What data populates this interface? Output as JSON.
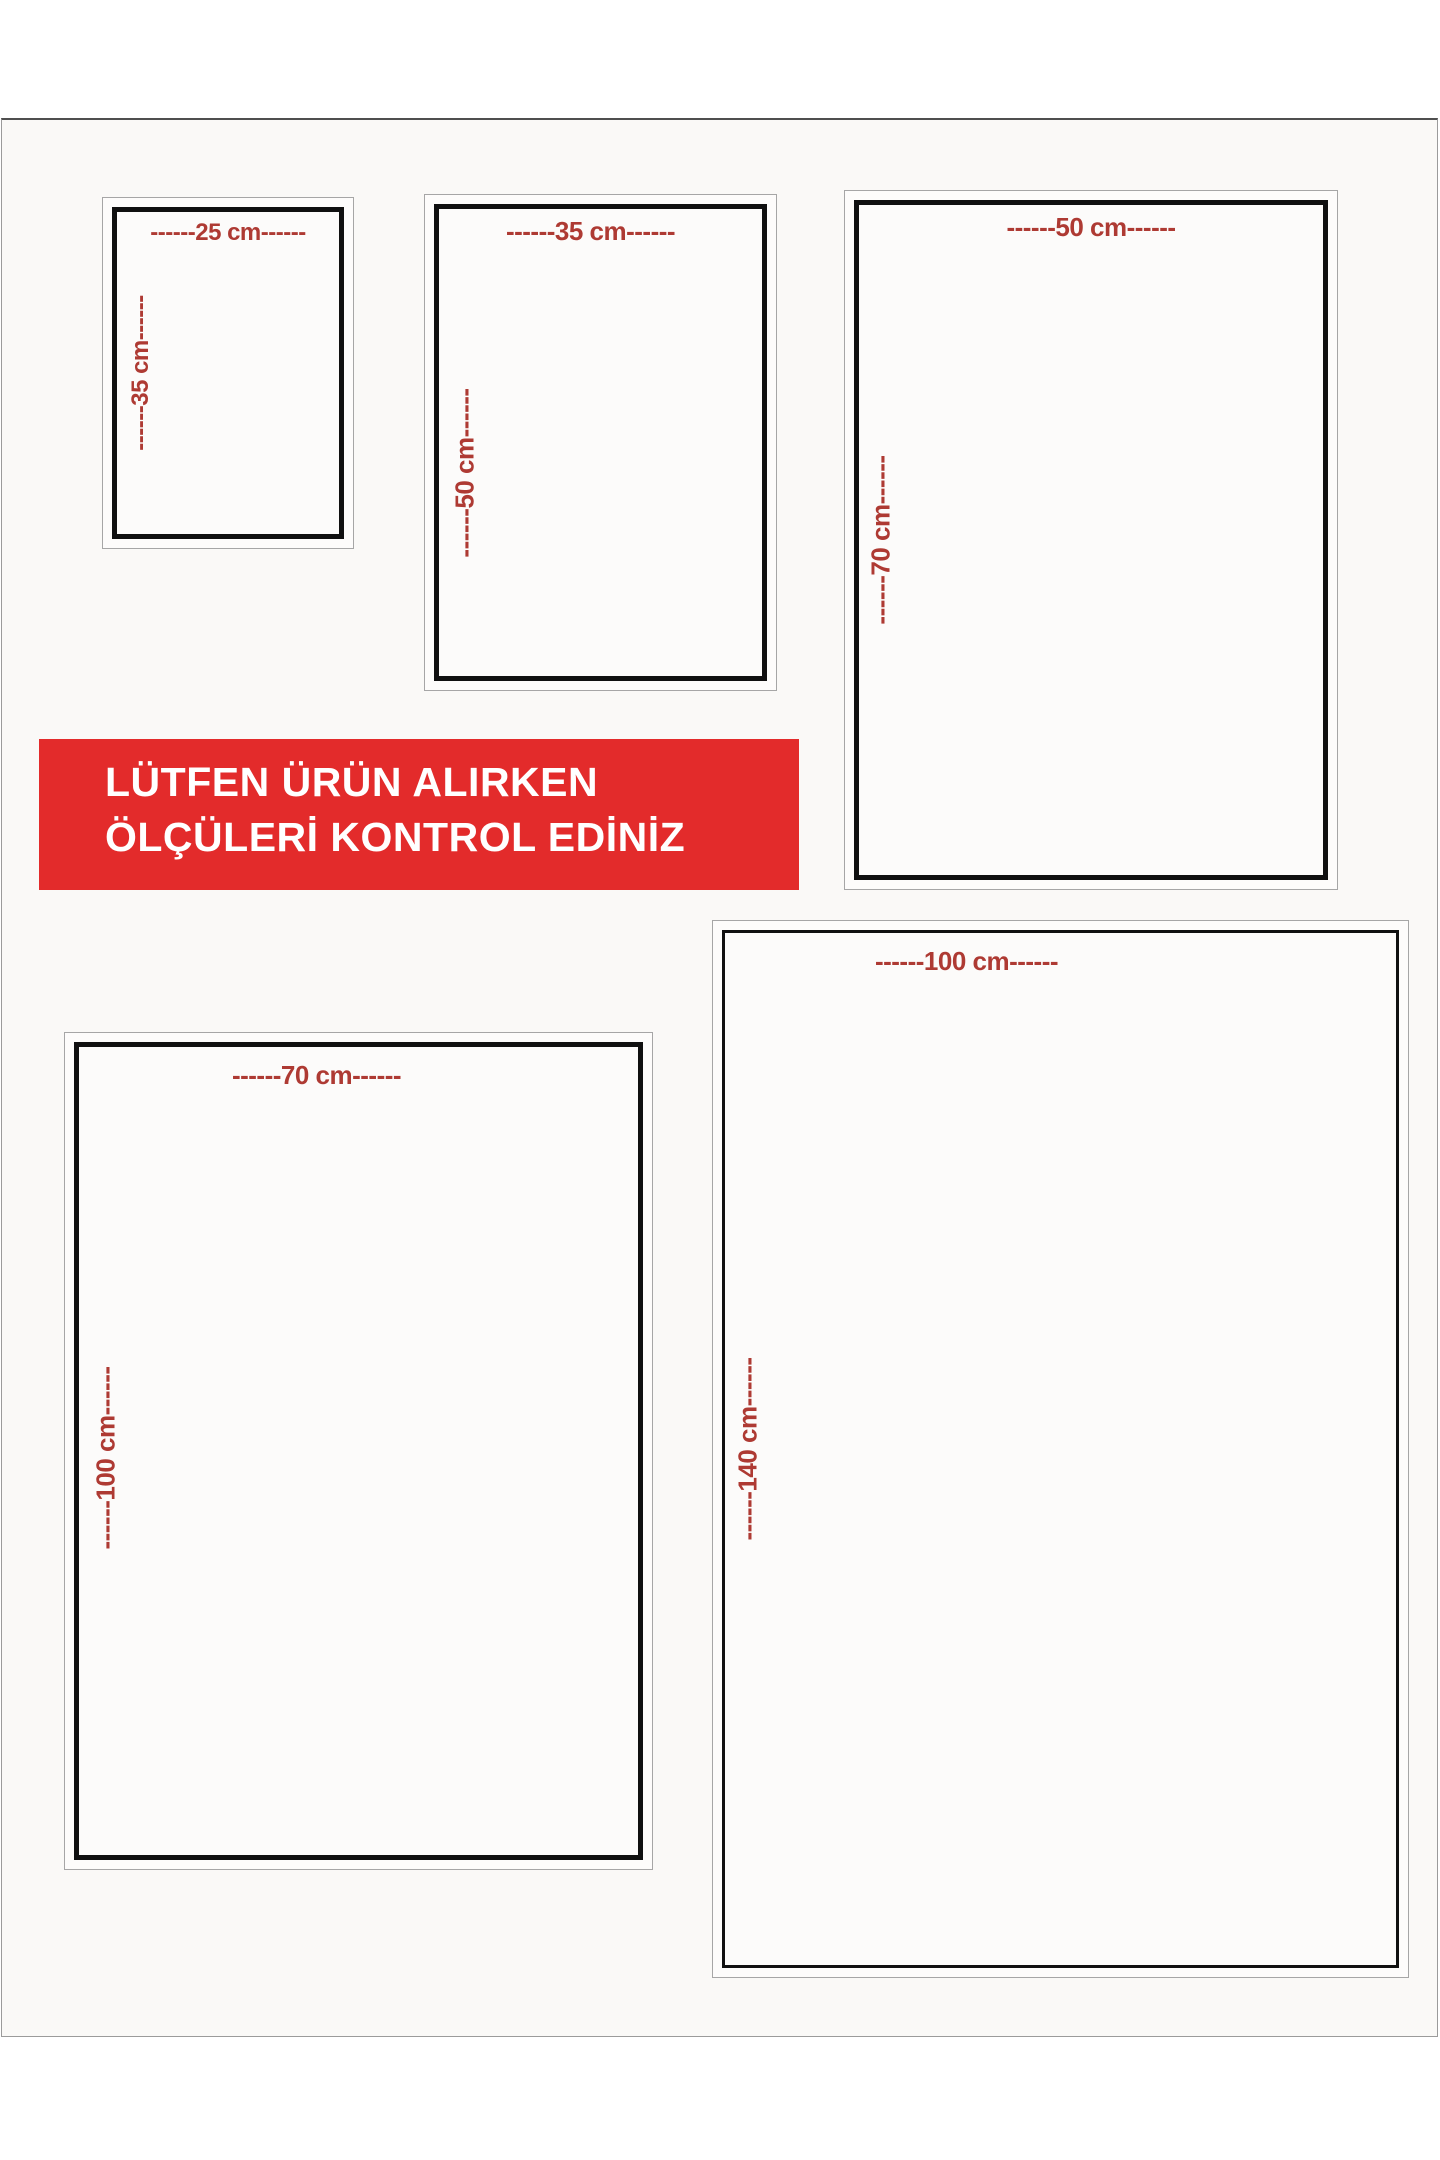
{
  "colors": {
    "dimension_text": "#ae3a33",
    "banner_bg": "#e32b2b",
    "banner_text": "#ffffff",
    "photo_bg": "#faf9f7",
    "frame_black": "#101010",
    "frame_gray": "#a6a6a6"
  },
  "notice_banner": {
    "line1": "LÜTFEN ÜRÜN ALIRKEN",
    "line2": "ÖLÇÜLERİ KONTROL EDİNİZ"
  },
  "size_boxes": [
    {
      "name": "25x35",
      "width_cm": 25,
      "height_cm": 35,
      "width_label": "------25 cm------",
      "height_label": "------35 cm------"
    },
    {
      "name": "35x50",
      "width_cm": 35,
      "height_cm": 50,
      "width_label": "------35 cm------",
      "height_label": "------50 cm------"
    },
    {
      "name": "50x70",
      "width_cm": 50,
      "height_cm": 70,
      "width_label": "------50 cm------",
      "height_label": "------70 cm------"
    },
    {
      "name": "70x100",
      "width_cm": 70,
      "height_cm": 100,
      "width_label": "------70 cm------",
      "height_label": "------100 cm------"
    },
    {
      "name": "100x140",
      "width_cm": 100,
      "height_cm": 140,
      "width_label": "------100 cm------",
      "height_label": "------140 cm------"
    }
  ]
}
